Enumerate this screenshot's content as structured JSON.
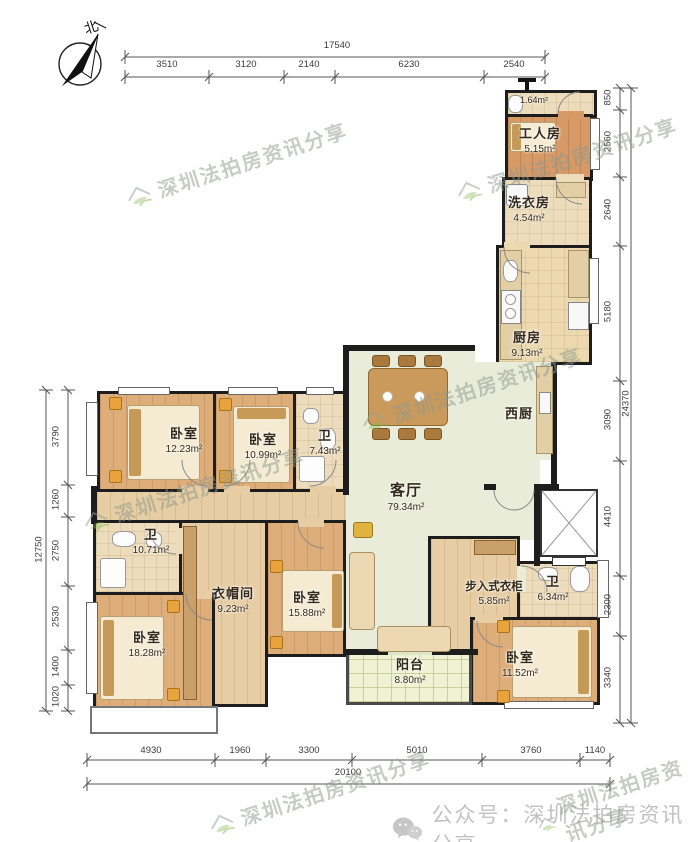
{
  "compass": {
    "label": "北"
  },
  "dims": {
    "top": {
      "total": "17540",
      "segments": [
        "3510",
        "3120",
        "2140",
        "6230",
        "2540"
      ]
    },
    "bottom": {
      "total": "20100",
      "segments": [
        "4930",
        "1960",
        "3300",
        "5010",
        "3760",
        "1140"
      ]
    },
    "left": {
      "total": "12750",
      "segments": [
        "3790",
        "1260",
        "2750",
        "2530",
        "1400",
        "1020"
      ]
    },
    "right": {
      "total": "24370",
      "segments": [
        "850",
        "2560",
        "2640",
        "5180",
        "3090",
        "4410",
        "2300",
        "3340"
      ]
    }
  },
  "rooms": [
    {
      "name": "bath-top",
      "label": "",
      "area": "1.64m²"
    },
    {
      "name": "worker-room",
      "label": "工人房",
      "area": "5.15m²"
    },
    {
      "name": "laundry-room",
      "label": "洗衣房",
      "area": "4.54m²"
    },
    {
      "name": "kitchen",
      "label": "厨房",
      "area": "9.13m²"
    },
    {
      "name": "west-kitchen",
      "label": "西厨",
      "area": ""
    },
    {
      "name": "living-room",
      "label": "客厅",
      "area": "79.34m²"
    },
    {
      "name": "bedroom-nw",
      "label": "卧室",
      "area": "12.23m²"
    },
    {
      "name": "bedroom-n",
      "label": "卧室",
      "area": "10.99m²"
    },
    {
      "name": "bath-n",
      "label": "卫",
      "area": "7.43m²"
    },
    {
      "name": "bath-w",
      "label": "卫",
      "area": "10.71m²"
    },
    {
      "name": "cloakroom",
      "label": "衣帽间",
      "area": "9.23m²"
    },
    {
      "name": "bedroom-c",
      "label": "卧室",
      "area": "15.88m²"
    },
    {
      "name": "bedroom-sw",
      "label": "卧室",
      "area": "18.28m²"
    },
    {
      "name": "walkin-closet",
      "label": "步入式衣柜",
      "area": "5.85m²"
    },
    {
      "name": "bath-se",
      "label": "卫",
      "area": "6.34m²"
    },
    {
      "name": "bedroom-se",
      "label": "卧室",
      "area": "11.52m²"
    },
    {
      "name": "balcony",
      "label": "阳台",
      "area": "8.80m²"
    }
  ],
  "watermark": {
    "text": "深圳法拍房资讯分享"
  },
  "footer": {
    "text": "公众号：深圳法拍房资讯分享"
  }
}
